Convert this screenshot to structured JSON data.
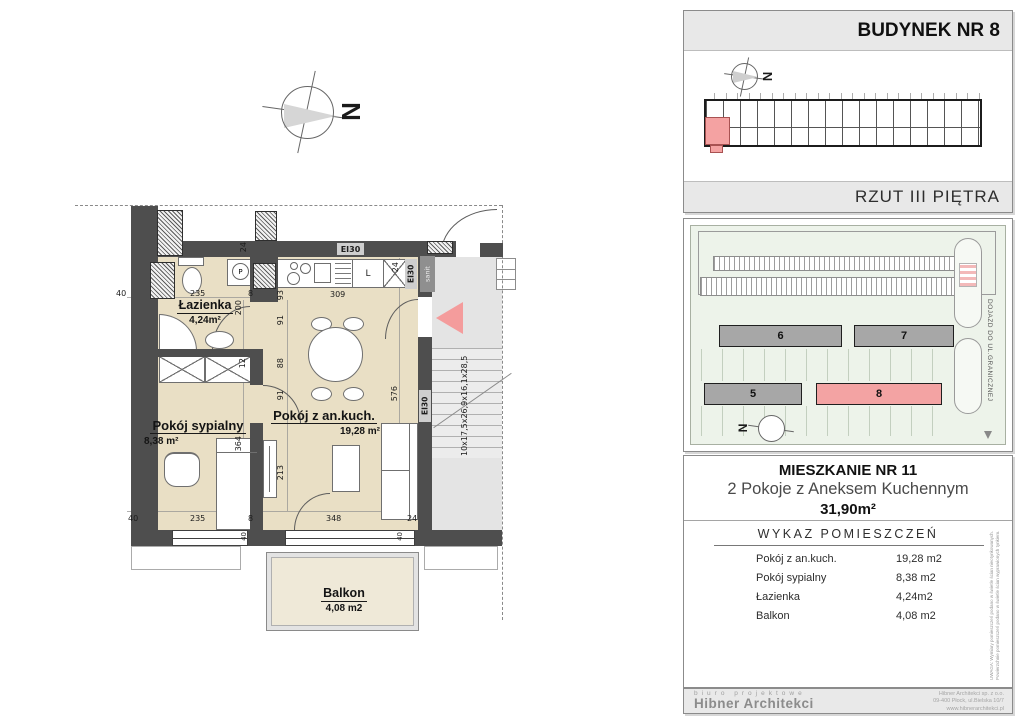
{
  "plan": {
    "north_letter": "N",
    "rooms": [
      {
        "name": "Łazienka",
        "area": "4,24m²"
      },
      {
        "name": "Pokój sypialny",
        "area": "8,38 m²"
      },
      {
        "name": "Pokój z an.kuch.",
        "area": "19,28 m²"
      },
      {
        "name": "Balkon",
        "area": "4,08 m2"
      }
    ],
    "dims": {
      "d0": "40",
      "d1": "235",
      "d2": "8",
      "d3": "24",
      "d4": "93",
      "d5": "309",
      "d6": "24",
      "d7": "200",
      "d8": "91",
      "d9": "88",
      "d10": "91",
      "d11": "12",
      "d12": "364",
      "d13": "213",
      "d14": "576",
      "d15": "40",
      "d16": "235",
      "d17": "8",
      "d18": "348",
      "d19": "24",
      "d20": "40",
      "d21": "40"
    },
    "wall_labels": {
      "ei30": "EI30",
      "sanit": "sanit",
      "stair_dims": "10x17,5x26,9x16,1x28,5"
    },
    "kitchen_fridge": "L",
    "washer": "P"
  },
  "sidebar": {
    "building_panel": {
      "title": "BUDYNEK NR 8",
      "subtitle": "RZUT III PIĘTRA",
      "north_letter": "N"
    },
    "site_panel": {
      "buildings": {
        "b5": "5",
        "b6": "6",
        "b7": "7",
        "b8": "8"
      },
      "road_label": "DOJAZD DO UL.GRANICZNEJ",
      "north_letter": "N"
    },
    "apartment_panel": {
      "title": "MIESZKANIE NR 11",
      "subtitle": "2 Pokoje z Aneksem Kuchennym",
      "total_area": "31,90m²",
      "table_title": "WYKAZ POMIESZCZEŃ",
      "rows": [
        {
          "label": "Pokój z an.kuch.",
          "value": "19,28 m2"
        },
        {
          "label": "Pokój sypialny",
          "value": "8,38 m2"
        },
        {
          "label": "Łazienka",
          "value": "4,24m2"
        },
        {
          "label": "Balkon",
          "value": "4,08 m2"
        }
      ],
      "disclaimer": "UWAGA: Wymiary pomieszczeń podano w świetle ścian nieotynkowanych. Powierzchnie pomieszczeń podano w świetle ścian wyprawionych tynkiem."
    },
    "footer": {
      "tagline": "biuro projektowe",
      "company": "Hibner Architekci",
      "address1": "Hibner Architekci sp. z o.o.",
      "address2": "09-400 Płock, ul.Bielska 10/7",
      "address3": "www.hibnerarchitekci.pl"
    }
  }
}
